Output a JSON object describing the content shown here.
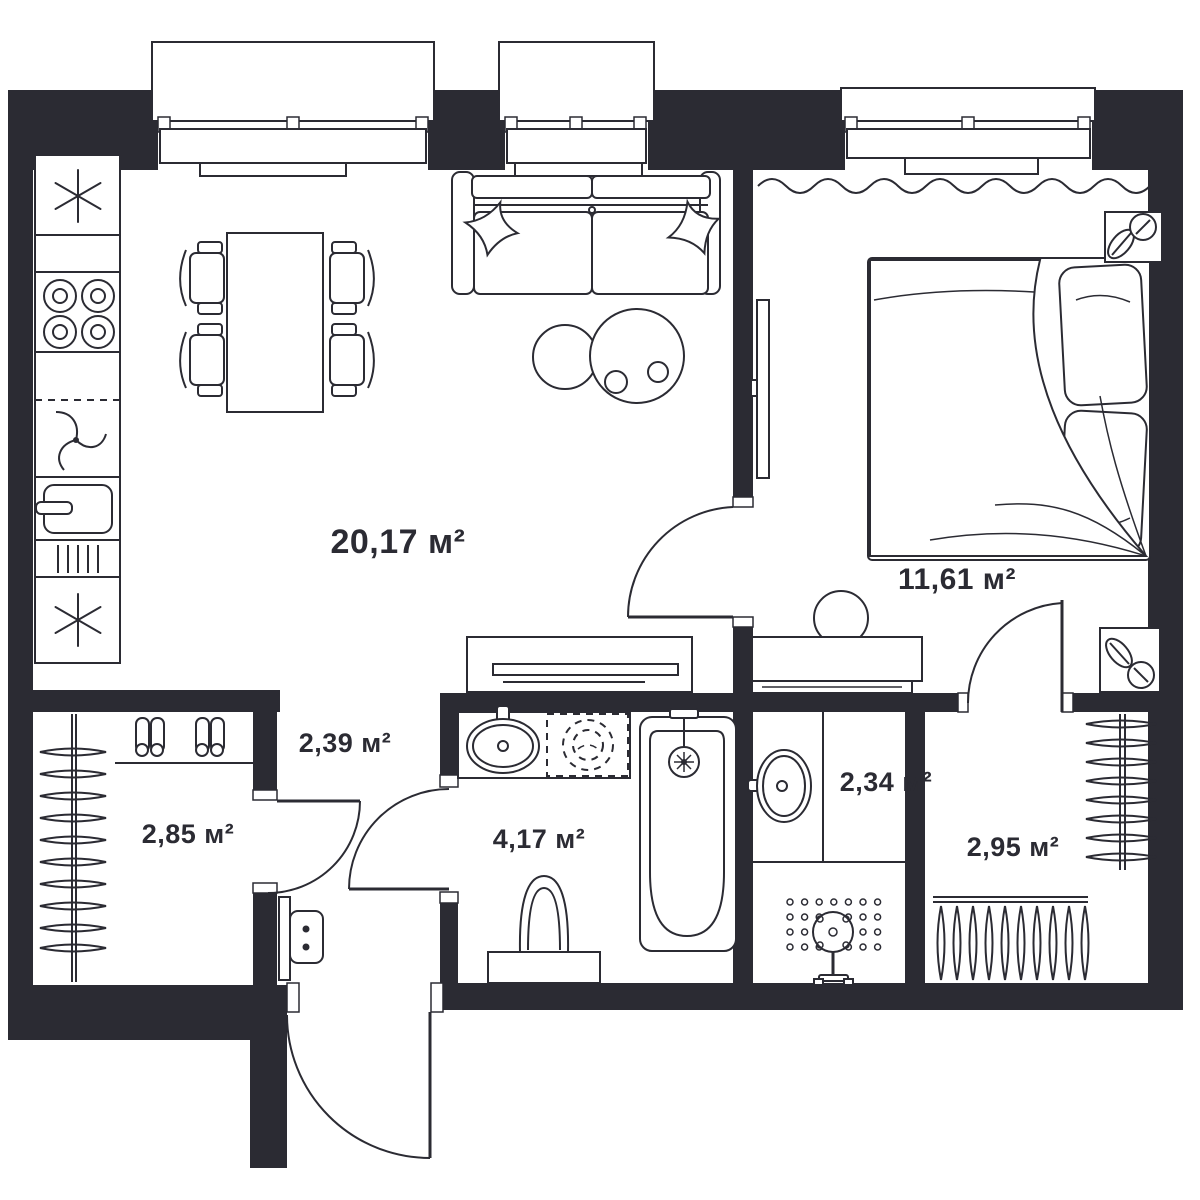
{
  "plan": {
    "title": "apartment-floor-plan",
    "unit_suffix": "м²",
    "rooms": [
      {
        "id": "living-kitchen",
        "area_label": "20,17 м²",
        "area_value": "20,17"
      },
      {
        "id": "bedroom",
        "area_label": "11,61 м²",
        "area_value": "11,61"
      },
      {
        "id": "hallway",
        "area_label": "2,39 м²",
        "area_value": "2,39"
      },
      {
        "id": "wardrobe-left",
        "area_label": "2,85 м²",
        "area_value": "2,85"
      },
      {
        "id": "bathroom",
        "area_label": "4,17 м²",
        "area_value": "4,17"
      },
      {
        "id": "shower-room",
        "area_label": "2,34 м²",
        "area_value": "2,34"
      },
      {
        "id": "closet-right",
        "area_label": "2,95 м²",
        "area_value": "2,95"
      }
    ],
    "icons": [
      "fridge-snowflake-icon",
      "freezer-snowflake-icon",
      "stove-burners-icon",
      "hood-swirl-icon",
      "kitchen-sink-icon",
      "drainboard-icon",
      "dining-table",
      "chair",
      "sofa",
      "pillow-icon",
      "coffee-table",
      "tv-icon",
      "window",
      "curtain-icon",
      "bed",
      "blanket-icon",
      "nightstand",
      "lamp-icon",
      "mirror-dresser",
      "console-table",
      "vanity-sink-icon",
      "washing-machine-icon",
      "bathtub-icon",
      "toilet-icon",
      "shower-head-icon",
      "shower-drain-dots",
      "hanger-icon",
      "shoes-icon",
      "intercom-panel",
      "door-arc"
    ],
    "colors": {
      "wall": "#2b2b33",
      "line": "#2b2b33",
      "background": "#ffffff"
    }
  }
}
